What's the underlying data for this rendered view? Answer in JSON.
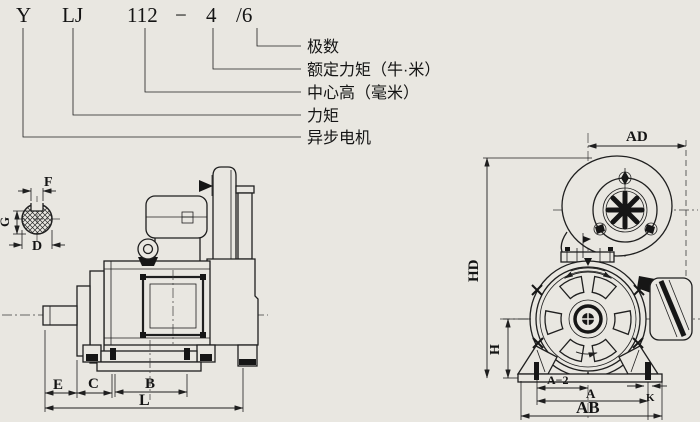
{
  "model_code": {
    "series": "Y",
    "type": "LJ",
    "frame": "112",
    "dash": "−",
    "poles_main": "4",
    "poles_alt": "/6"
  },
  "code_labels": {
    "poles": "极数",
    "rated_torque": "额定力矩（牛·米）",
    "center_height": "中心高（毫米）",
    "torque": "力矩",
    "async_motor": "异步电机"
  },
  "dims": {
    "f": "F",
    "g": "G",
    "d": "D",
    "e": "E",
    "c": "C",
    "b": "B",
    "l": "L",
    "ad": "AD",
    "hd": "HD",
    "h": "H",
    "a2": "A−2",
    "a": "A",
    "k": "K",
    "ab": "AB"
  },
  "colors": {
    "paper": "#e9e7e1",
    "ink": "#1f1f1f"
  }
}
